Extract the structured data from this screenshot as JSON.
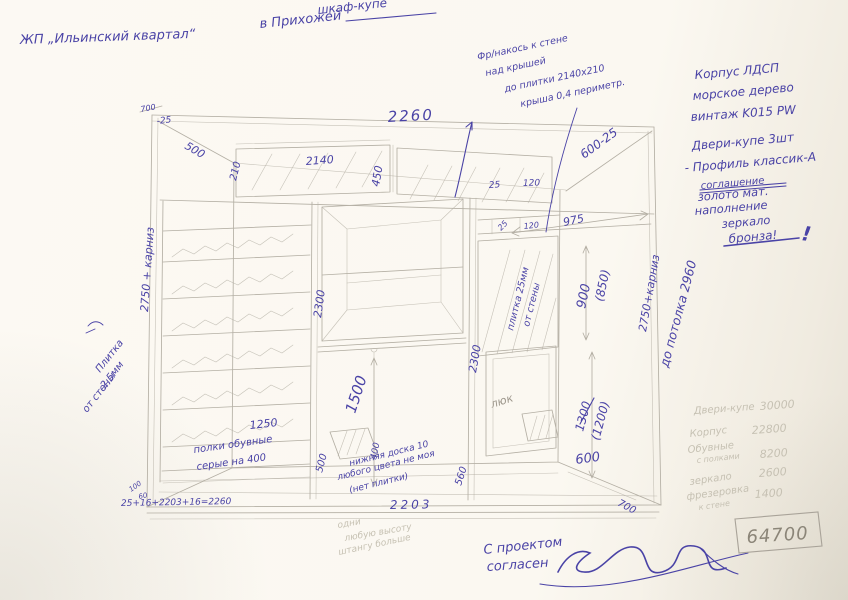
{
  "colors": {
    "ink": "#4a43a6",
    "pencil": "#b4afa4",
    "pencil-faint": "#c6c1b3",
    "pencil-dark": "#8b8578",
    "paper": "#fbf8f1"
  },
  "titles": {
    "project": "ЖП „Ильинский квартал“",
    "item1": "шкаф-купе",
    "item2": "в Прихожей"
  },
  "spec": {
    "l1": "Корпус ЛДСП",
    "l2": "морское дерево",
    "l3": "винтаж K015 PW",
    "d1": "Двери-купе 3шт",
    "d2": "- Профиль классик-А",
    "d_strike": "соглашение",
    "d3": "золото мат.",
    "d4": "наполнение",
    "d5": "зеркало",
    "d6": "бронза!",
    "bang": "!"
  },
  "fr_note": {
    "l1": "Фр/накось к стене",
    "l2": "над крышей",
    "l3": "до плитки 2140х210",
    "l4": "крыша 0,4 периметр."
  },
  "dims": {
    "top_width": "2260",
    "top_small": "700",
    "minus25": "-25",
    "left_diag": "500",
    "shelf_h": "210",
    "shelf_w": "2140",
    "mezz_h": "450",
    "m25": "25",
    "m120": "120",
    "right_diag": "600-25",
    "r975": "975",
    "r25": "25",
    "r120": "120",
    "r900": "900",
    "r850": "(850)",
    "left_height": "2750 + карниз",
    "right_height": "2750+карниз",
    "ceiling": "до потолка 2960",
    "mid_left_h": "2300",
    "mid_right_h": "2300",
    "rod_h": "1500",
    "b500": "500",
    "b400": "400",
    "b560": "560",
    "v1300": "1300",
    "v1200": "(1200)",
    "d600": "600",
    "d700": "700",
    "shoe_w": "1250",
    "bottom_w": "2203",
    "bottom_formula": "25+16+2203+16=2260",
    "c100": "100",
    "c60": "60"
  },
  "labels": {
    "mirror_note1": "плитка 25мм",
    "mirror_note2": "от стены",
    "wall_note1": "Плитка",
    "wall_note2": "2,5мм",
    "wall_note3": "от стены",
    "hatch": "люк",
    "shoe1": "полки обувные",
    "shoe2": "серые на 400",
    "board1": "нижняя доска 10",
    "board2": "любого цвета не моя",
    "board3": "(нет плитки)",
    "pencil1": "одни",
    "pencil2": "любую высоту",
    "pencil3": "штангу больше"
  },
  "prices": {
    "rows": [
      {
        "label": "Двери-купе",
        "value": "30000"
      },
      {
        "label": "Корпус",
        "value": "22800"
      },
      {
        "label": "Обувные",
        "label2": "с полками",
        "value": "8200"
      },
      {
        "label": "зеркало",
        "value": "2600"
      },
      {
        "label": "фрезеровка",
        "label2": "к стене",
        "value": "1400"
      }
    ],
    "total": "64700"
  },
  "approval": {
    "line1": "С проектом",
    "line2": "согласен"
  }
}
